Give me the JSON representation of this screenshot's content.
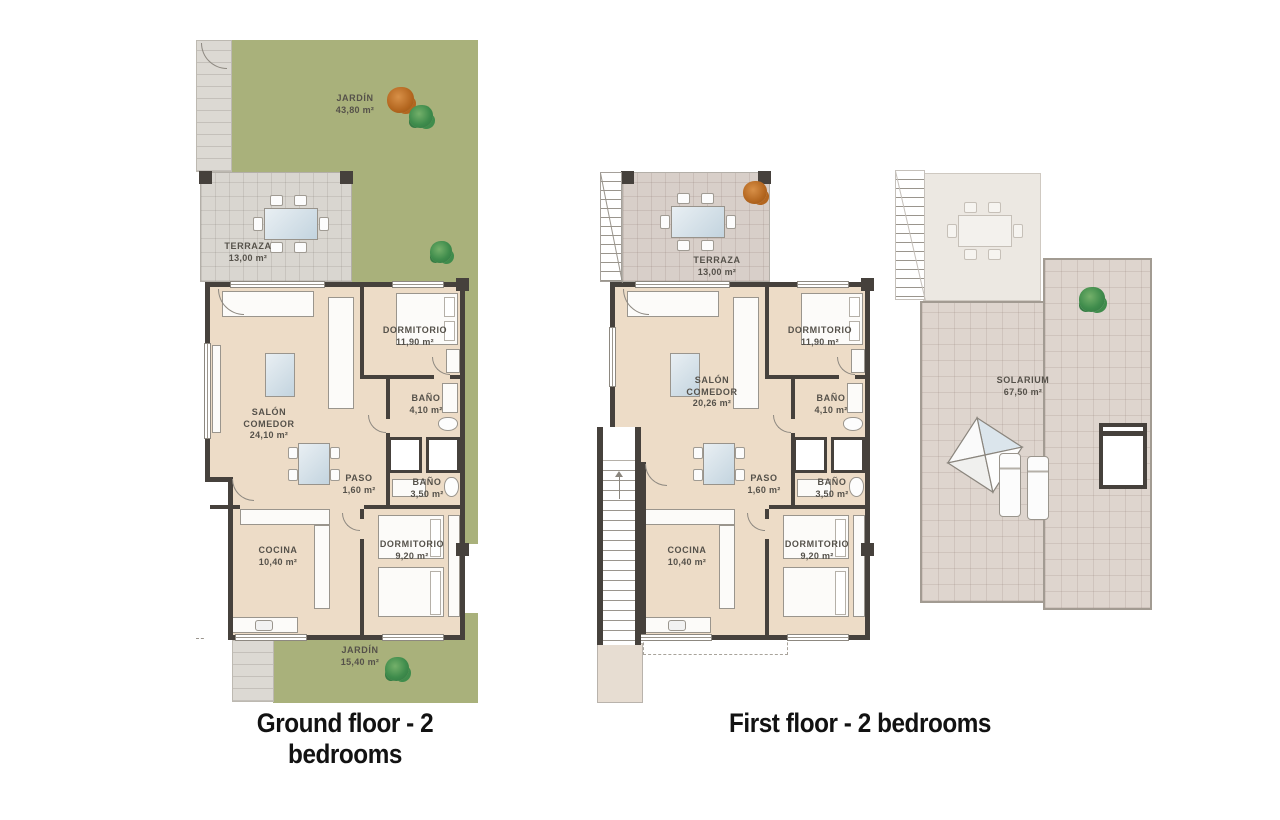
{
  "plans": [
    {
      "caption": "Ground floor - 2 bedrooms",
      "rooms": {
        "jardin_top": {
          "name": "JARDÍN",
          "area": "43,80 m²"
        },
        "terraza": {
          "name": "TERRAZA",
          "area": "13,00 m²"
        },
        "salon": {
          "name": "SALÓN COMEDOR",
          "area": "24,10 m²"
        },
        "dormitorio1": {
          "name": "DORMITORIO",
          "area": "11,90 m²"
        },
        "bano1": {
          "name": "BAÑO",
          "area": "4,10 m²"
        },
        "paso": {
          "name": "PASO",
          "area": "1,60 m²"
        },
        "bano2": {
          "name": "BAÑO",
          "area": "3,50 m²"
        },
        "cocina": {
          "name": "COCINA",
          "area": "10,40 m²"
        },
        "dormitorio2": {
          "name": "DORMITORIO",
          "area": "9,20 m²"
        },
        "jardin_bottom": {
          "name": "JARDÍN",
          "area": "15,40 m²"
        }
      }
    },
    {
      "caption": "First floor - 2 bedrooms",
      "rooms": {
        "terraza": {
          "name": "TERRAZA",
          "area": "13,00 m²"
        },
        "salon": {
          "name": "SALÓN COMEDOR",
          "area": "20,26 m²"
        },
        "dormitorio1": {
          "name": "DORMITORIO",
          "area": "11,90 m²"
        },
        "bano1": {
          "name": "BAÑO",
          "area": "4,10 m²"
        },
        "paso": {
          "name": "PASO",
          "area": "1,60 m²"
        },
        "bano2": {
          "name": "BAÑO",
          "area": "3,50 m²"
        },
        "cocina": {
          "name": "COCINA",
          "area": "10,40 m²"
        },
        "dormitorio2": {
          "name": "DORMITORIO",
          "area": "9,20 m²"
        },
        "solarium": {
          "name": "SOLARIUM",
          "area": "67,50 m²"
        }
      }
    }
  ],
  "colors": {
    "background": "#ffffff",
    "garden_green": "#a9b17b",
    "apartment_floor": "#eddcc7",
    "wall_dark": "#46413c",
    "terrace_ground": "#d9d6d0",
    "terrace_first": "#d8cfc9",
    "solarium_floor": "#ded5ce",
    "caption_text": "#121212",
    "label_text": "#55514a"
  }
}
